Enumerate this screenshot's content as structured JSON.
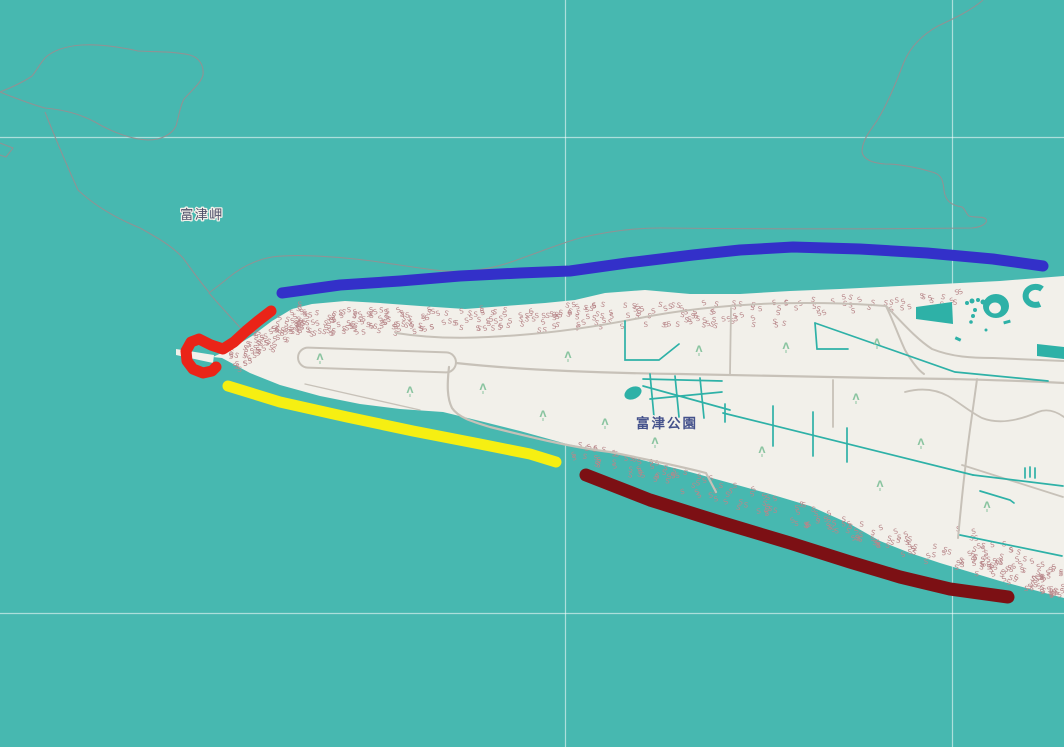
{
  "map": {
    "title": "Futtsu Cape park map with drawn route annotations",
    "labels": [
      {
        "id": "cape",
        "text": "富津岬",
        "x": 202,
        "y": 219,
        "color": "#50506a",
        "size": 13,
        "weight": 500,
        "spacing": 1.5
      },
      {
        "id": "park",
        "text": "富津公園",
        "x": 667,
        "y": 428,
        "color": "#45528c",
        "size": 13.5,
        "weight": 600,
        "spacing": 2
      }
    ],
    "palette": {
      "water": "#47b8b0",
      "land": "#f2f0ea",
      "pond": "#2eb1a7",
      "road": "#c7c1b8",
      "boundary": "#8f9394",
      "scrub": "#b8878a",
      "tree": "#8ac4a0",
      "graticule": "rgba(255,255,255,0.55)",
      "label_halo": "#f3f1eb"
    },
    "graticule": {
      "vertical_x": [
        565.5,
        952.5
      ],
      "horizontal_y": [
        137.5,
        613.5
      ]
    },
    "icons": {
      "tree": "tree-icon",
      "scrub": "scrub-icon"
    },
    "annotations": [
      {
        "name": "blue-annotation-line",
        "color": "#3330c9",
        "width": 11,
        "points": [
          [
            282,
            293
          ],
          [
            340,
            285
          ],
          [
            400,
            281
          ],
          [
            460,
            276
          ],
          [
            520,
            273
          ],
          [
            570,
            271
          ],
          [
            627,
            263
          ],
          [
            693,
            255
          ],
          [
            740,
            250
          ],
          [
            793,
            247
          ],
          [
            860,
            249
          ],
          [
            927,
            253
          ],
          [
            993,
            259
          ],
          [
            1043,
            266
          ]
        ]
      },
      {
        "name": "red-annotation-line",
        "color": "#ea2418",
        "width": 11,
        "points": [
          [
            271,
            311
          ],
          [
            258,
            321
          ],
          [
            246,
            331
          ],
          [
            234,
            342
          ],
          [
            223,
            349
          ],
          [
            211,
            345
          ],
          [
            199,
            339
          ],
          [
            191,
            342
          ],
          [
            186,
            351
          ],
          [
            187,
            361
          ],
          [
            193,
            369
          ],
          [
            203,
            373
          ],
          [
            212,
            371
          ],
          [
            216,
            367
          ]
        ]
      },
      {
        "name": "yellow-annotation-line",
        "color": "#f6ef12",
        "width": 11,
        "points": [
          [
            228,
            386
          ],
          [
            280,
            402
          ],
          [
            347,
            417
          ],
          [
            413,
            431
          ],
          [
            480,
            444
          ],
          [
            530,
            454
          ],
          [
            556,
            462
          ]
        ]
      },
      {
        "name": "dark-red-annotation-line",
        "color": "#7c1014",
        "width": 13,
        "points": [
          [
            586,
            475
          ],
          [
            650,
            500
          ],
          [
            720,
            522
          ],
          [
            790,
            543
          ],
          [
            850,
            562
          ],
          [
            900,
            577
          ],
          [
            950,
            589
          ],
          [
            1008,
            597
          ]
        ]
      }
    ]
  }
}
